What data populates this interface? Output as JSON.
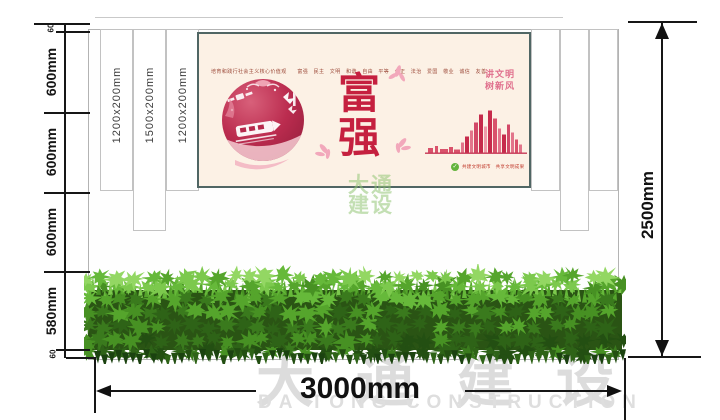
{
  "drawing": {
    "left_dimension_segments": [
      "60",
      "600mm",
      "600mm",
      "600mm",
      "580mm",
      "60"
    ],
    "right_total_height": "2500mm",
    "bottom_total_width": "3000mm",
    "slat_labels": [
      "1200x200mm",
      "1500x200mm",
      "1200x200mm"
    ]
  },
  "poster": {
    "core_values_line": "培育和践行社会主义核心价值观　　富强　民主　文明　和谐　自由　平等　公正　法治　爱国　敬业　诚信　友善",
    "main_characters": [
      "富",
      "强"
    ],
    "side_slogan_lines": [
      "讲文明",
      "树新风"
    ],
    "footer_text": "共建文明城市　共享文明成果"
  },
  "watermark": {
    "center_lines": [
      "大通",
      "建设"
    ],
    "company_cn": "大通建设",
    "company_en": "DA TONG CONSTRUCTION"
  },
  "colors": {
    "accent_red": "#c5203f",
    "poster_background": "#fcf1e5",
    "poster_border": "#506664",
    "dimension_line": "#161616",
    "hedge_green": "#3a7a1d",
    "watermark_gray": "#dcdcdc",
    "watermark_green": "rgba(146,196,116,0.55)"
  }
}
